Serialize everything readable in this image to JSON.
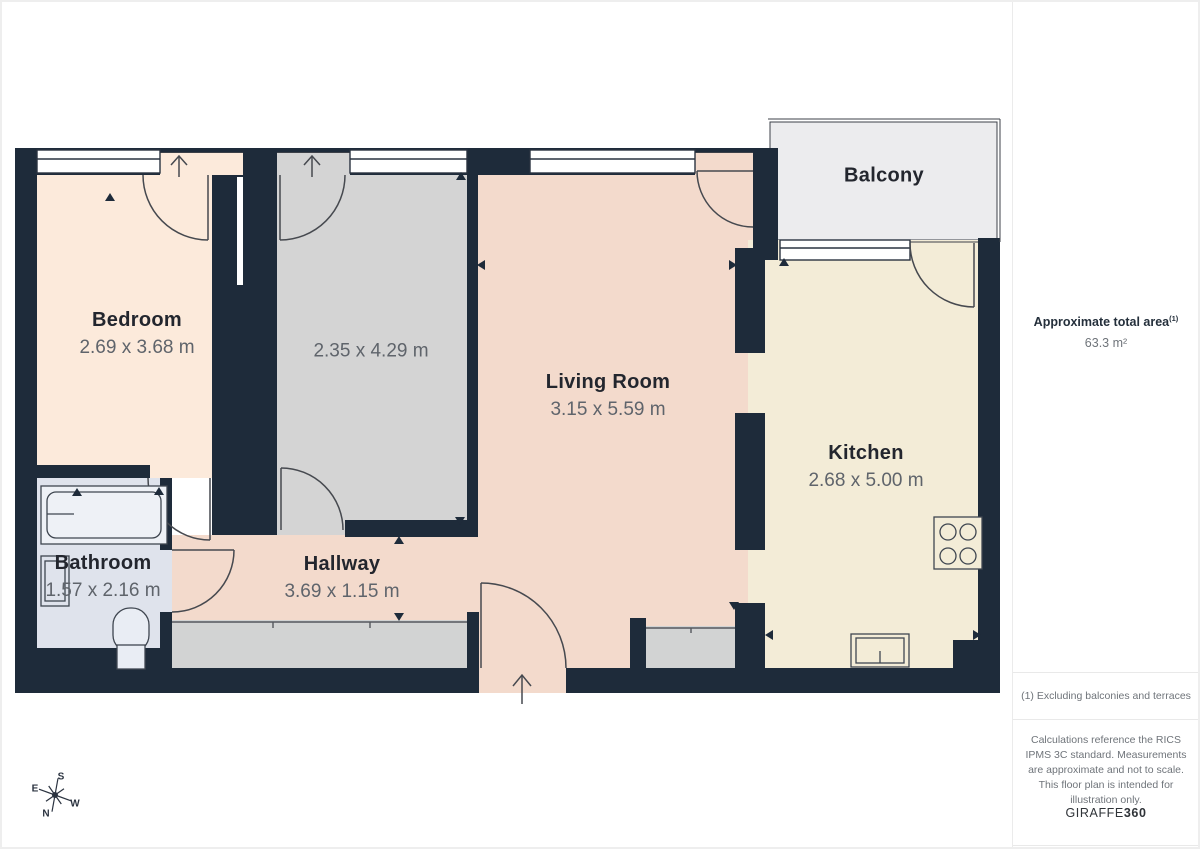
{
  "floorplan": {
    "rooms": [
      {
        "name": "Bedroom",
        "dims": "2.69 x 3.68 m"
      },
      {
        "name": "",
        "dims": "2.35 x 4.29 m"
      },
      {
        "name": "Living Room",
        "dims": "3.15 x 5.59 m"
      },
      {
        "name": "Kitchen",
        "dims": "2.68 x 5.00 m"
      },
      {
        "name": "Bathroom",
        "dims": "1.57 x 2.16 m"
      },
      {
        "name": "Hallway",
        "dims": "3.69 x 1.15 m"
      },
      {
        "name": "Balcony",
        "dims": ""
      }
    ],
    "compass": {
      "n": "N",
      "s": "S",
      "e": "E",
      "w": "W"
    },
    "colors": {
      "wall": "#1e2b3a",
      "bedroom": "#fceadb",
      "gray-room": "#d4d4d4",
      "living": "#f3dacc",
      "kitchen": "#f3ecd7",
      "bathroom": "#dfe3ec",
      "balcony": "#ececee",
      "closet": "#d2d3d3",
      "line": "#3c4048",
      "label": "#23262e",
      "dim": "#5f646b"
    }
  },
  "sidebar": {
    "total_area_label": "Approximate total area",
    "total_area_superscript": "(1)",
    "total_area_value": "63.3 m²",
    "footnote": "(1) Excluding balconies and terraces",
    "disclaimer": "Calculations reference the RICS IPMS 3C standard. Measurements are approximate and not to scale. This floor plan is intended for illustration only.",
    "brand_regular": "GIRAFFE",
    "brand_bold": "360"
  }
}
